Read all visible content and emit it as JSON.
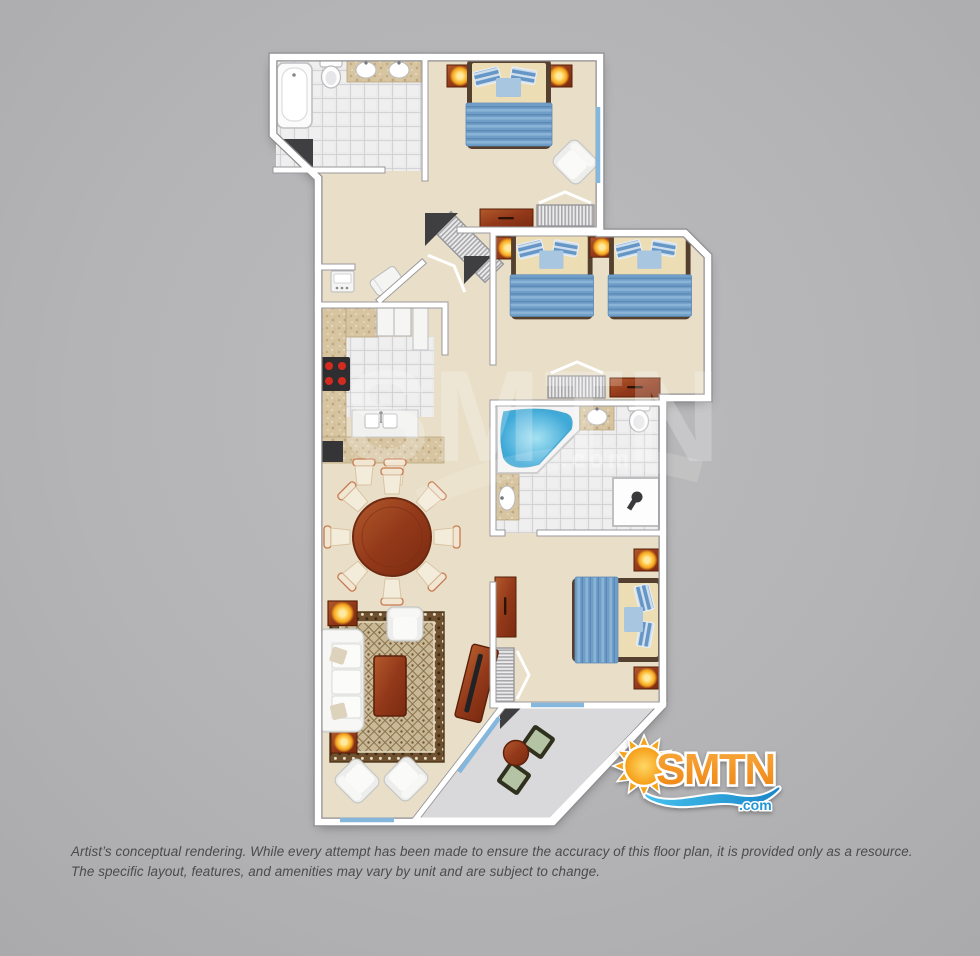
{
  "watermark": {
    "text": "SMTN",
    "suffix": ".com"
  },
  "logo": {
    "text": "SMTN",
    "suffix": ".com"
  },
  "disclaimer": {
    "line1": "Artist’s conceptual rendering. While every attempt has been made to ensure the accuracy of this floor plan, it is provided only as a resource.",
    "line2": "The specific layout, features, and amenities may vary by unit and are subject to change."
  },
  "colors": {
    "bg_light": "#bcbcbe",
    "bg_mid": "#b4b4b6",
    "bg_dark": "#aaaaac",
    "floor_beige": "#e9dfc8",
    "tile_white": "#ebebec",
    "wall_white": "#ffffff",
    "granite_tan": "#d7c5a2",
    "wood_brown": "#93391a",
    "bed_blue": "#6f9fc9",
    "bedding_cream": "#edddb4",
    "water_blue": "#3fa9d8",
    "balcony_gray": "#d9d9db",
    "window_blue": "#85b7dc",
    "dark_wall": "#3f3f41",
    "lamp_glow": "#f5a31c",
    "logo_orange": "#f6941d",
    "logo_blue": "#2196d6",
    "wave_blue": "#1a85c8",
    "text_color": "#4b4b4b",
    "watermark_color": "#ffffff"
  }
}
